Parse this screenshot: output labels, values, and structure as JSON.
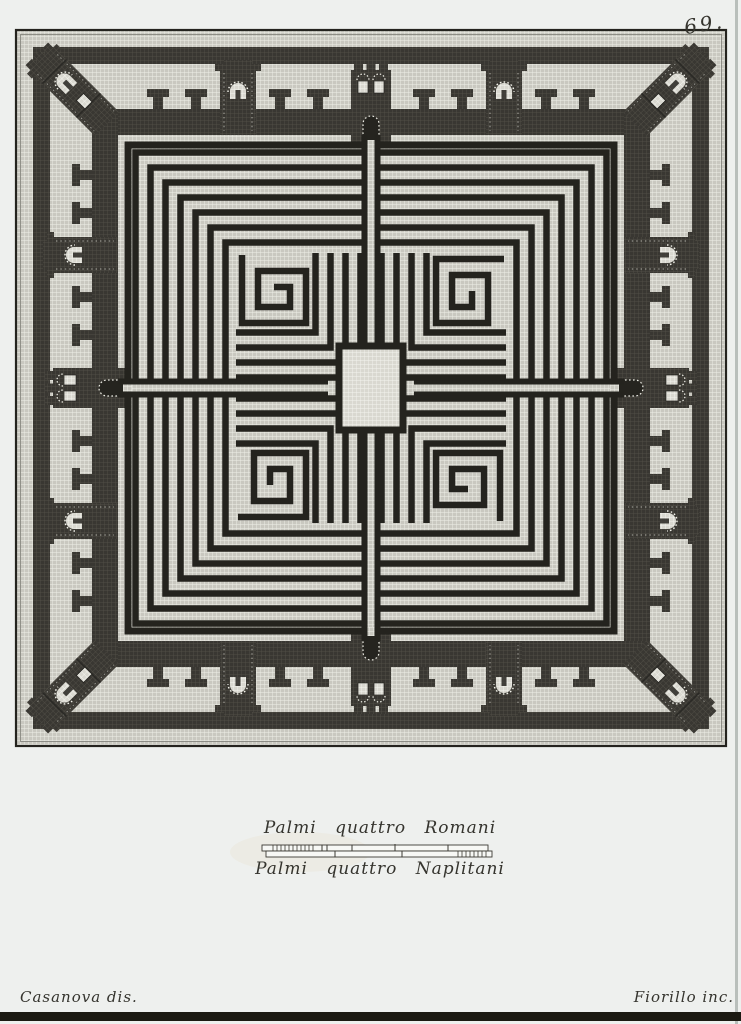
{
  "page": {
    "number": "69."
  },
  "scale_bar": {
    "label_top": "Palmi quattro Romani",
    "label_bottom": "Palmi quattro Naplitani"
  },
  "credits": {
    "delineator": "Casanova dis.",
    "engraver": "Fiorillo inc."
  },
  "colors": {
    "paper": "#eef0ee",
    "ink": "#24231e",
    "text": "#35342e",
    "mosaic_light_base": "#c9c8c0",
    "mosaic_light_grout": "#efefe8",
    "mosaic_lighter_base": "#d9d8d0",
    "mosaic_dark_base": "#393732",
    "mosaic_dark_grout": "#55524a",
    "page_edge_band": "#1b1a12"
  }
}
